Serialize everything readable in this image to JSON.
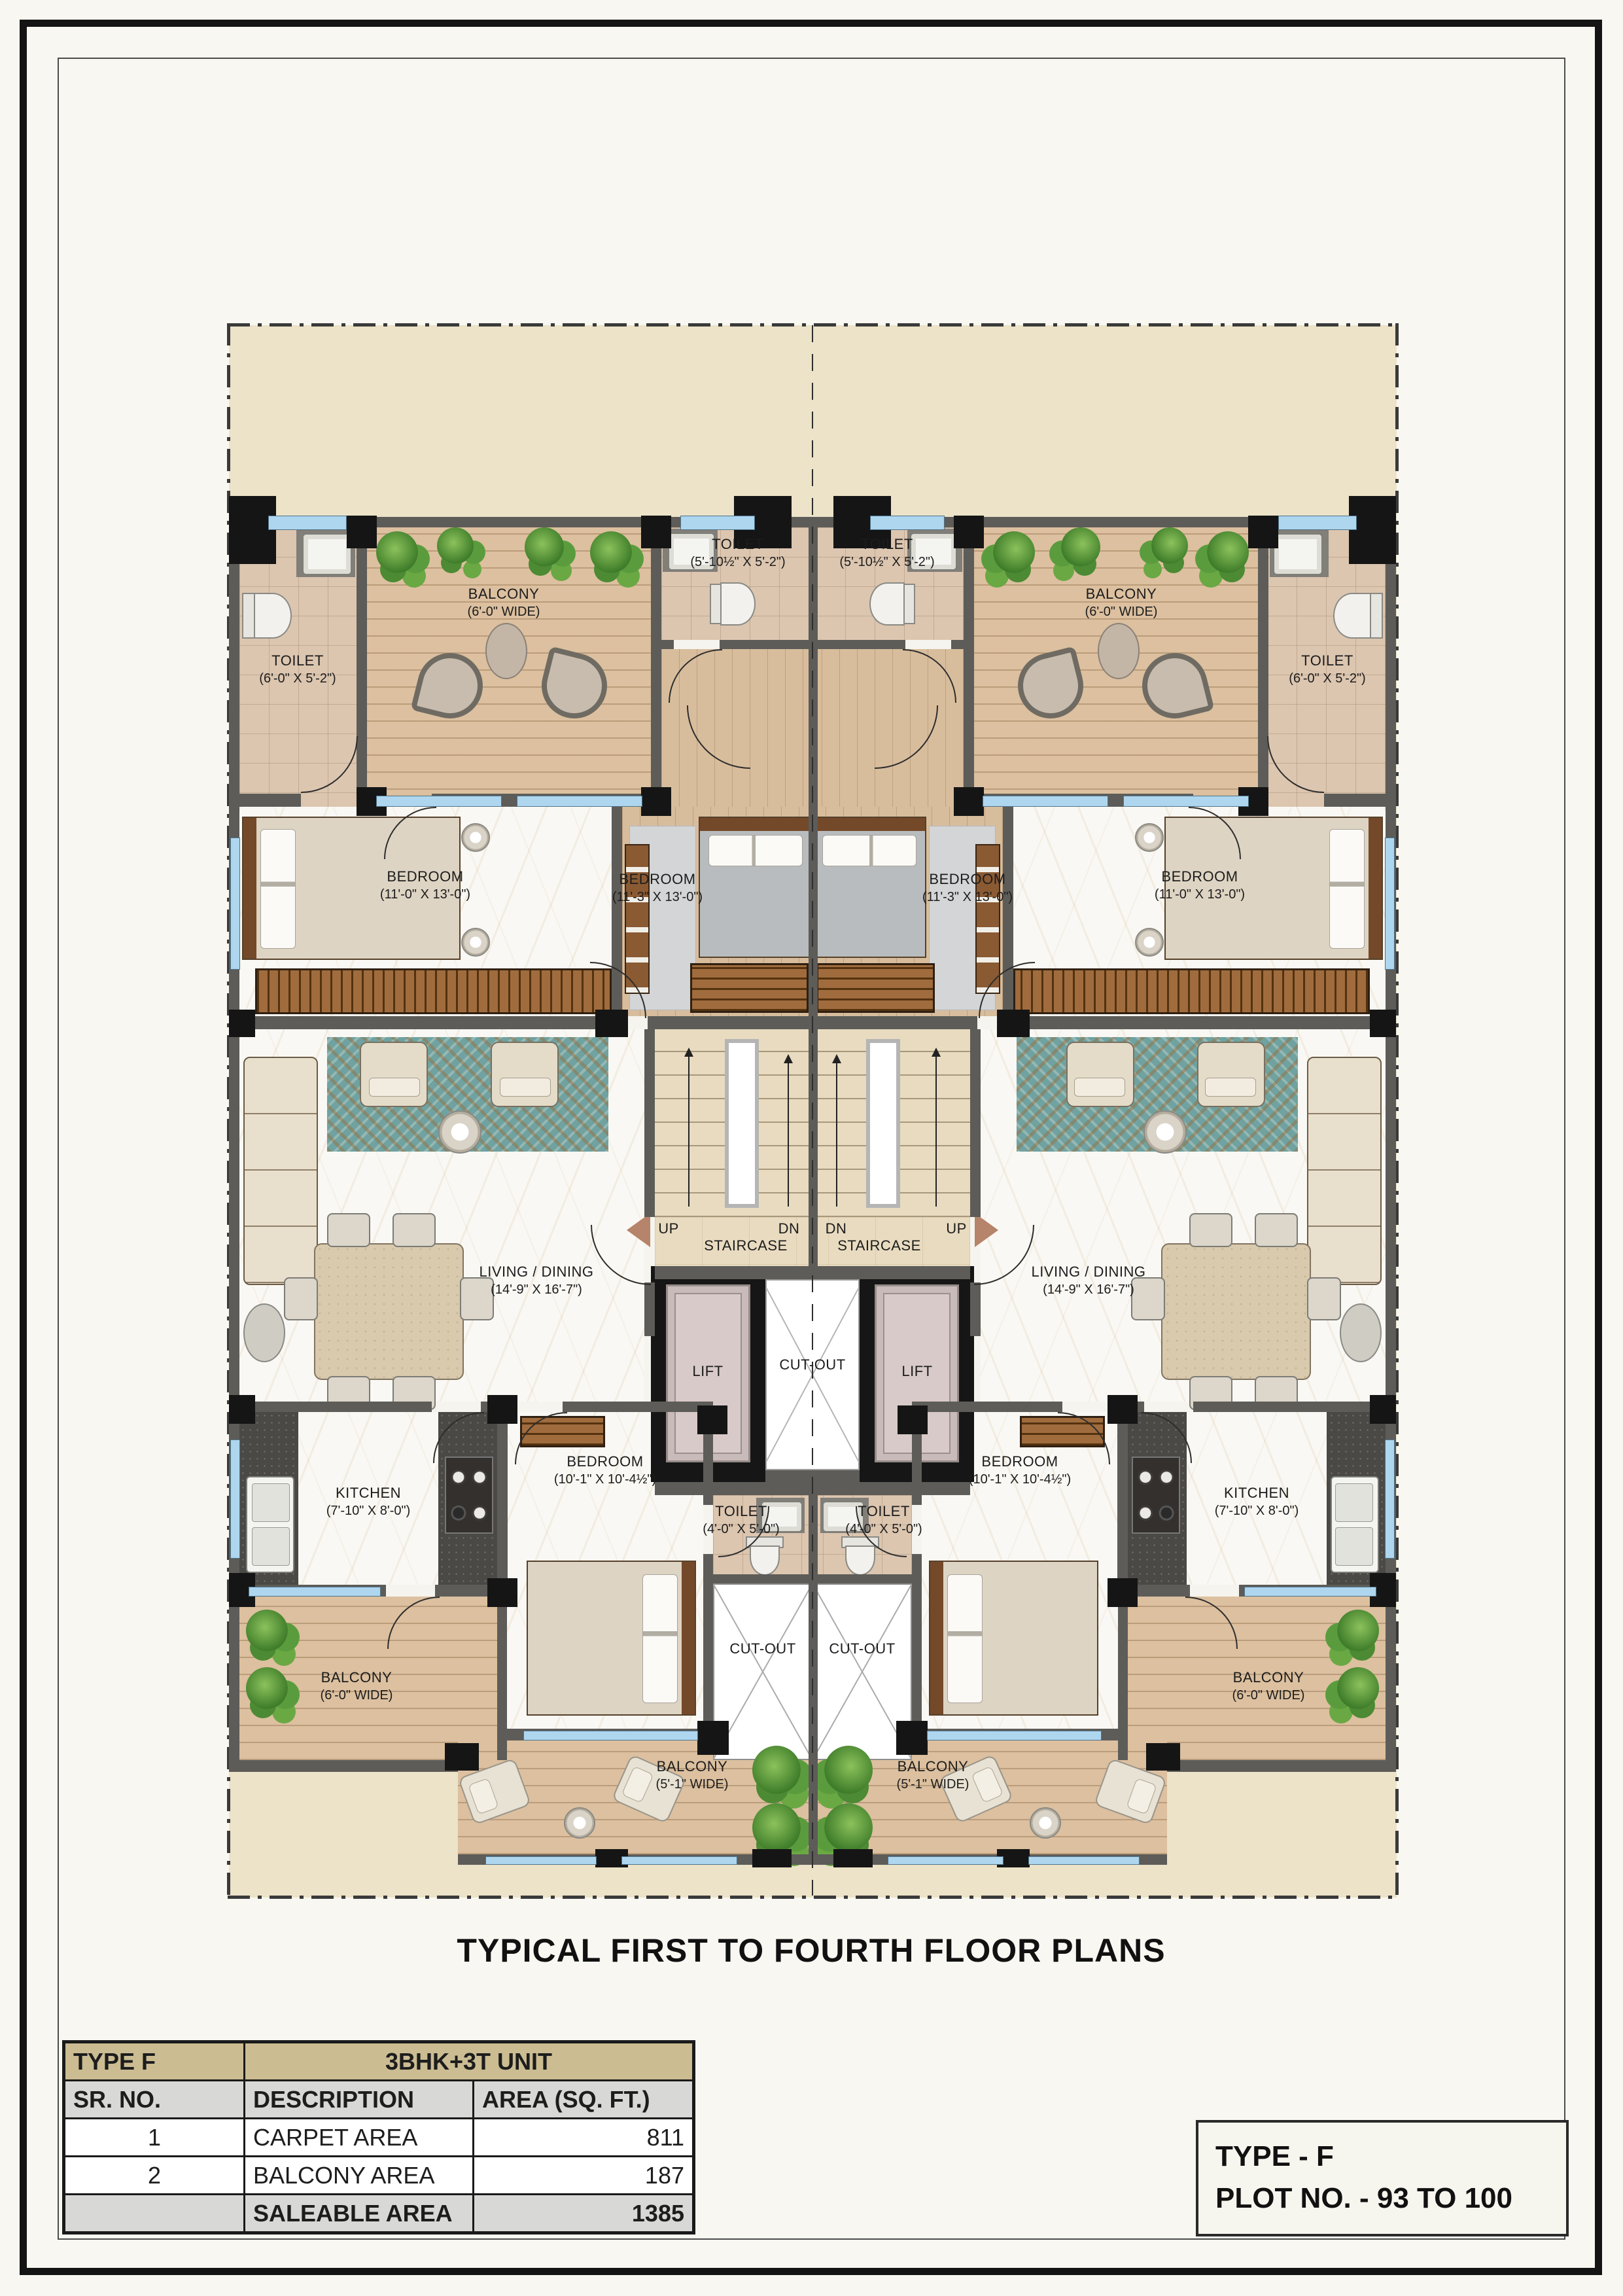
{
  "title": "TYPICAL FIRST TO FOURTH FLOOR PLANS",
  "plan": {
    "rooms": {
      "toilet_corner": {
        "name": "TOILET",
        "dims": "(6'-0\" X 5'-2\")"
      },
      "toilet_top_center": {
        "name": "TOILET",
        "dims": "(5'-10½\" X 5'-2\")"
      },
      "balcony_top": {
        "name": "BALCONY",
        "dims": "(6'-0\" WIDE)"
      },
      "bedroom_outer": {
        "name": "BEDROOM",
        "dims": "(11'-0\" X 13'-0\")"
      },
      "bedroom_center": {
        "name": "BEDROOM",
        "dims": "(11'-3\" X 13'-0\")"
      },
      "living_dining": {
        "name": "LIVING / DINING",
        "dims": "(14'-9\" X 16'-7\")"
      },
      "kitchen": {
        "name": "KITCHEN",
        "dims": "(7'-10\" X 8'-0\")"
      },
      "bedroom_small": {
        "name": "BEDROOM",
        "dims": "(10'-1\" X 10'-4½\")"
      },
      "toilet_small": {
        "name": "TOILET",
        "dims": "(4'-0\" X 5'-0\")"
      },
      "balcony_side": {
        "name": "BALCONY",
        "dims": "(6'-0\" WIDE)"
      },
      "balcony_bottom": {
        "name": "BALCONY",
        "dims": "(5'-1\" WIDE)"
      }
    },
    "stair": {
      "label": "STAIRCASE",
      "up": "UP",
      "dn": "DN"
    },
    "lift_label": "LIFT",
    "cutout_label": "CUT-OUT"
  },
  "area_table": {
    "type_label": "TYPE F",
    "unit_label": "3BHK+3T UNIT",
    "columns": [
      "SR. NO.",
      "DESCRIPTION",
      "AREA (SQ. FT.)"
    ],
    "rows": [
      {
        "sr": "1",
        "description": "CARPET AREA",
        "area": "811"
      },
      {
        "sr": "2",
        "description": "BALCONY AREA",
        "area": "187"
      },
      {
        "sr": "",
        "description": "SALEABLE AREA",
        "area": "1385"
      }
    ]
  },
  "footer_box": {
    "line1": "TYPE - F",
    "line2": "PLOT NO. - 93 TO 100"
  },
  "colors": {
    "wall": "#5d5c58",
    "plot_fill": "#ece3c8",
    "window_glass": "#aed6ef",
    "wood_floor": "#d8bd9d",
    "bath_tile": "#dcc6b0",
    "teal_rug": "#6fa2a0",
    "lift_wall": "#161616",
    "table_header": "#cbbc92"
  }
}
